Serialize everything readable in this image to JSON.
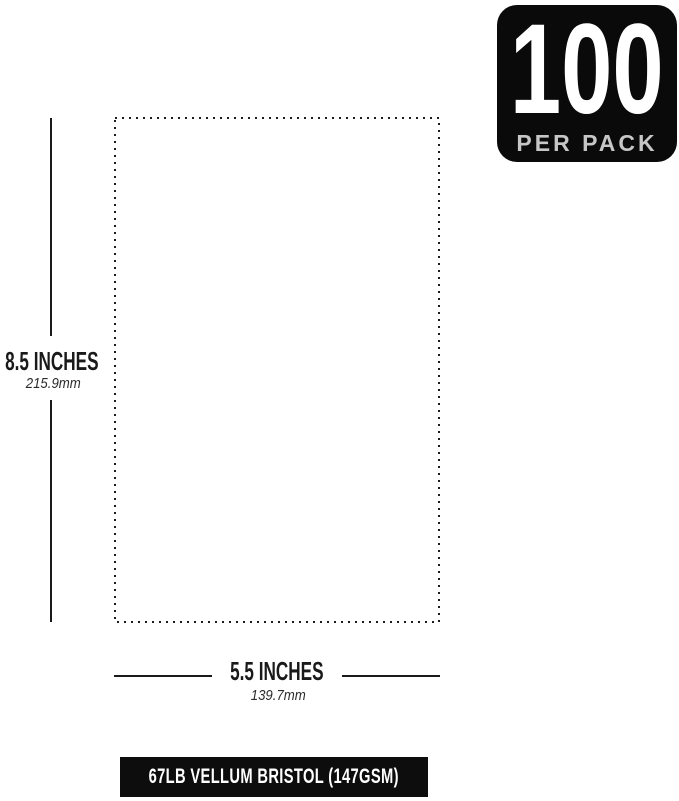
{
  "badge": {
    "count": "100",
    "label": "PER PACK",
    "bg_color": "#0a0a0a",
    "count_color": "#ffffff",
    "label_color": "#c6c6c6"
  },
  "dimensions": {
    "height": {
      "inches": "8.5 INCHES",
      "mm": "215.9mm"
    },
    "width": {
      "inches": "5.5 INCHES",
      "mm": "139.7mm"
    }
  },
  "footer": {
    "label": "67LB VELLUM BRISTOL (147GSM)",
    "bg_color": "#0d0d0d",
    "text_color": "#ffffff"
  },
  "colors": {
    "ink": "#1a1a1a",
    "background": "#ffffff"
  }
}
